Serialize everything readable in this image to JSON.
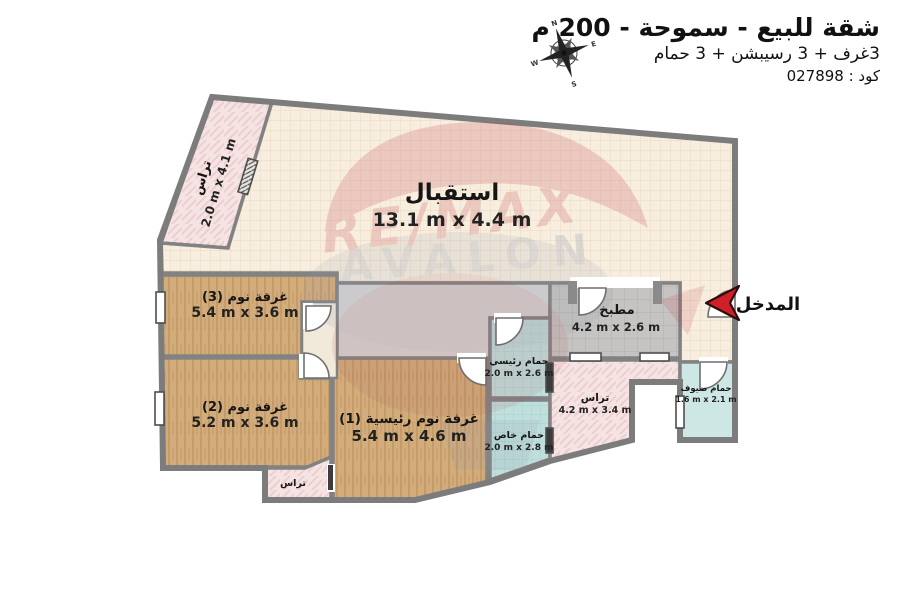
{
  "header": {
    "title": "شقة للبيع - سموحة - 200 م",
    "subtitle": "3غرف + 3 رسيبشن + 3 حمام",
    "code": "كود : 027898"
  },
  "entrance": {
    "label": "المدخل"
  },
  "watermark": {
    "brand": "RE/MAX",
    "office": "AVALON"
  },
  "compass": {
    "north": "N",
    "east": "E",
    "south": "S",
    "west": "W"
  },
  "rooms": {
    "reception": {
      "name": "استقبال",
      "dims": "13.1 m x 4.4 m"
    },
    "terrace_top": {
      "name": "تراس",
      "dims": "2.0 m x 4.1 m"
    },
    "bedroom3": {
      "name": "غرفة نوم (3)",
      "dims": "5.4 m x 3.6 m"
    },
    "bedroom2": {
      "name": "غرفة نوم (2)",
      "dims": "5.2 m x 3.6 m"
    },
    "master_bedroom": {
      "name": "غرفة نوم رئيسية (1)",
      "dims": "5.4 m x 4.6 m"
    },
    "kitchen": {
      "name": "مطبخ",
      "dims": "4.2 m x 2.6 m"
    },
    "main_bathroom": {
      "name": "حمام رئيسي",
      "dims": "2.0 m x 2.6 m"
    },
    "private_bathroom": {
      "name": "حمام خاص",
      "dims": "2.0 m x 2.8 m"
    },
    "guest_bathroom": {
      "name": "حمام ضيوف",
      "dims": "1.6 m x 2.1 m"
    },
    "terrace_right": {
      "name": "تراس",
      "dims": "4.2 m x 3.4 m"
    },
    "terrace_small": {
      "name": "تراس",
      "dims": ""
    }
  },
  "colors": {
    "wall": "#828282",
    "reception_fill": "#f7eedf",
    "bedroom_fill": "#d3ac7b",
    "terrace_fill": "#f6e4e4",
    "bathroom_fill": "#bfdfdc",
    "kitchen_fill": "#c6c4c2",
    "hallway_fill": "#d6d4d2",
    "accent_red": "#cf2027",
    "watermark_red": "#c0394a",
    "watermark_blue": "#71819f"
  }
}
